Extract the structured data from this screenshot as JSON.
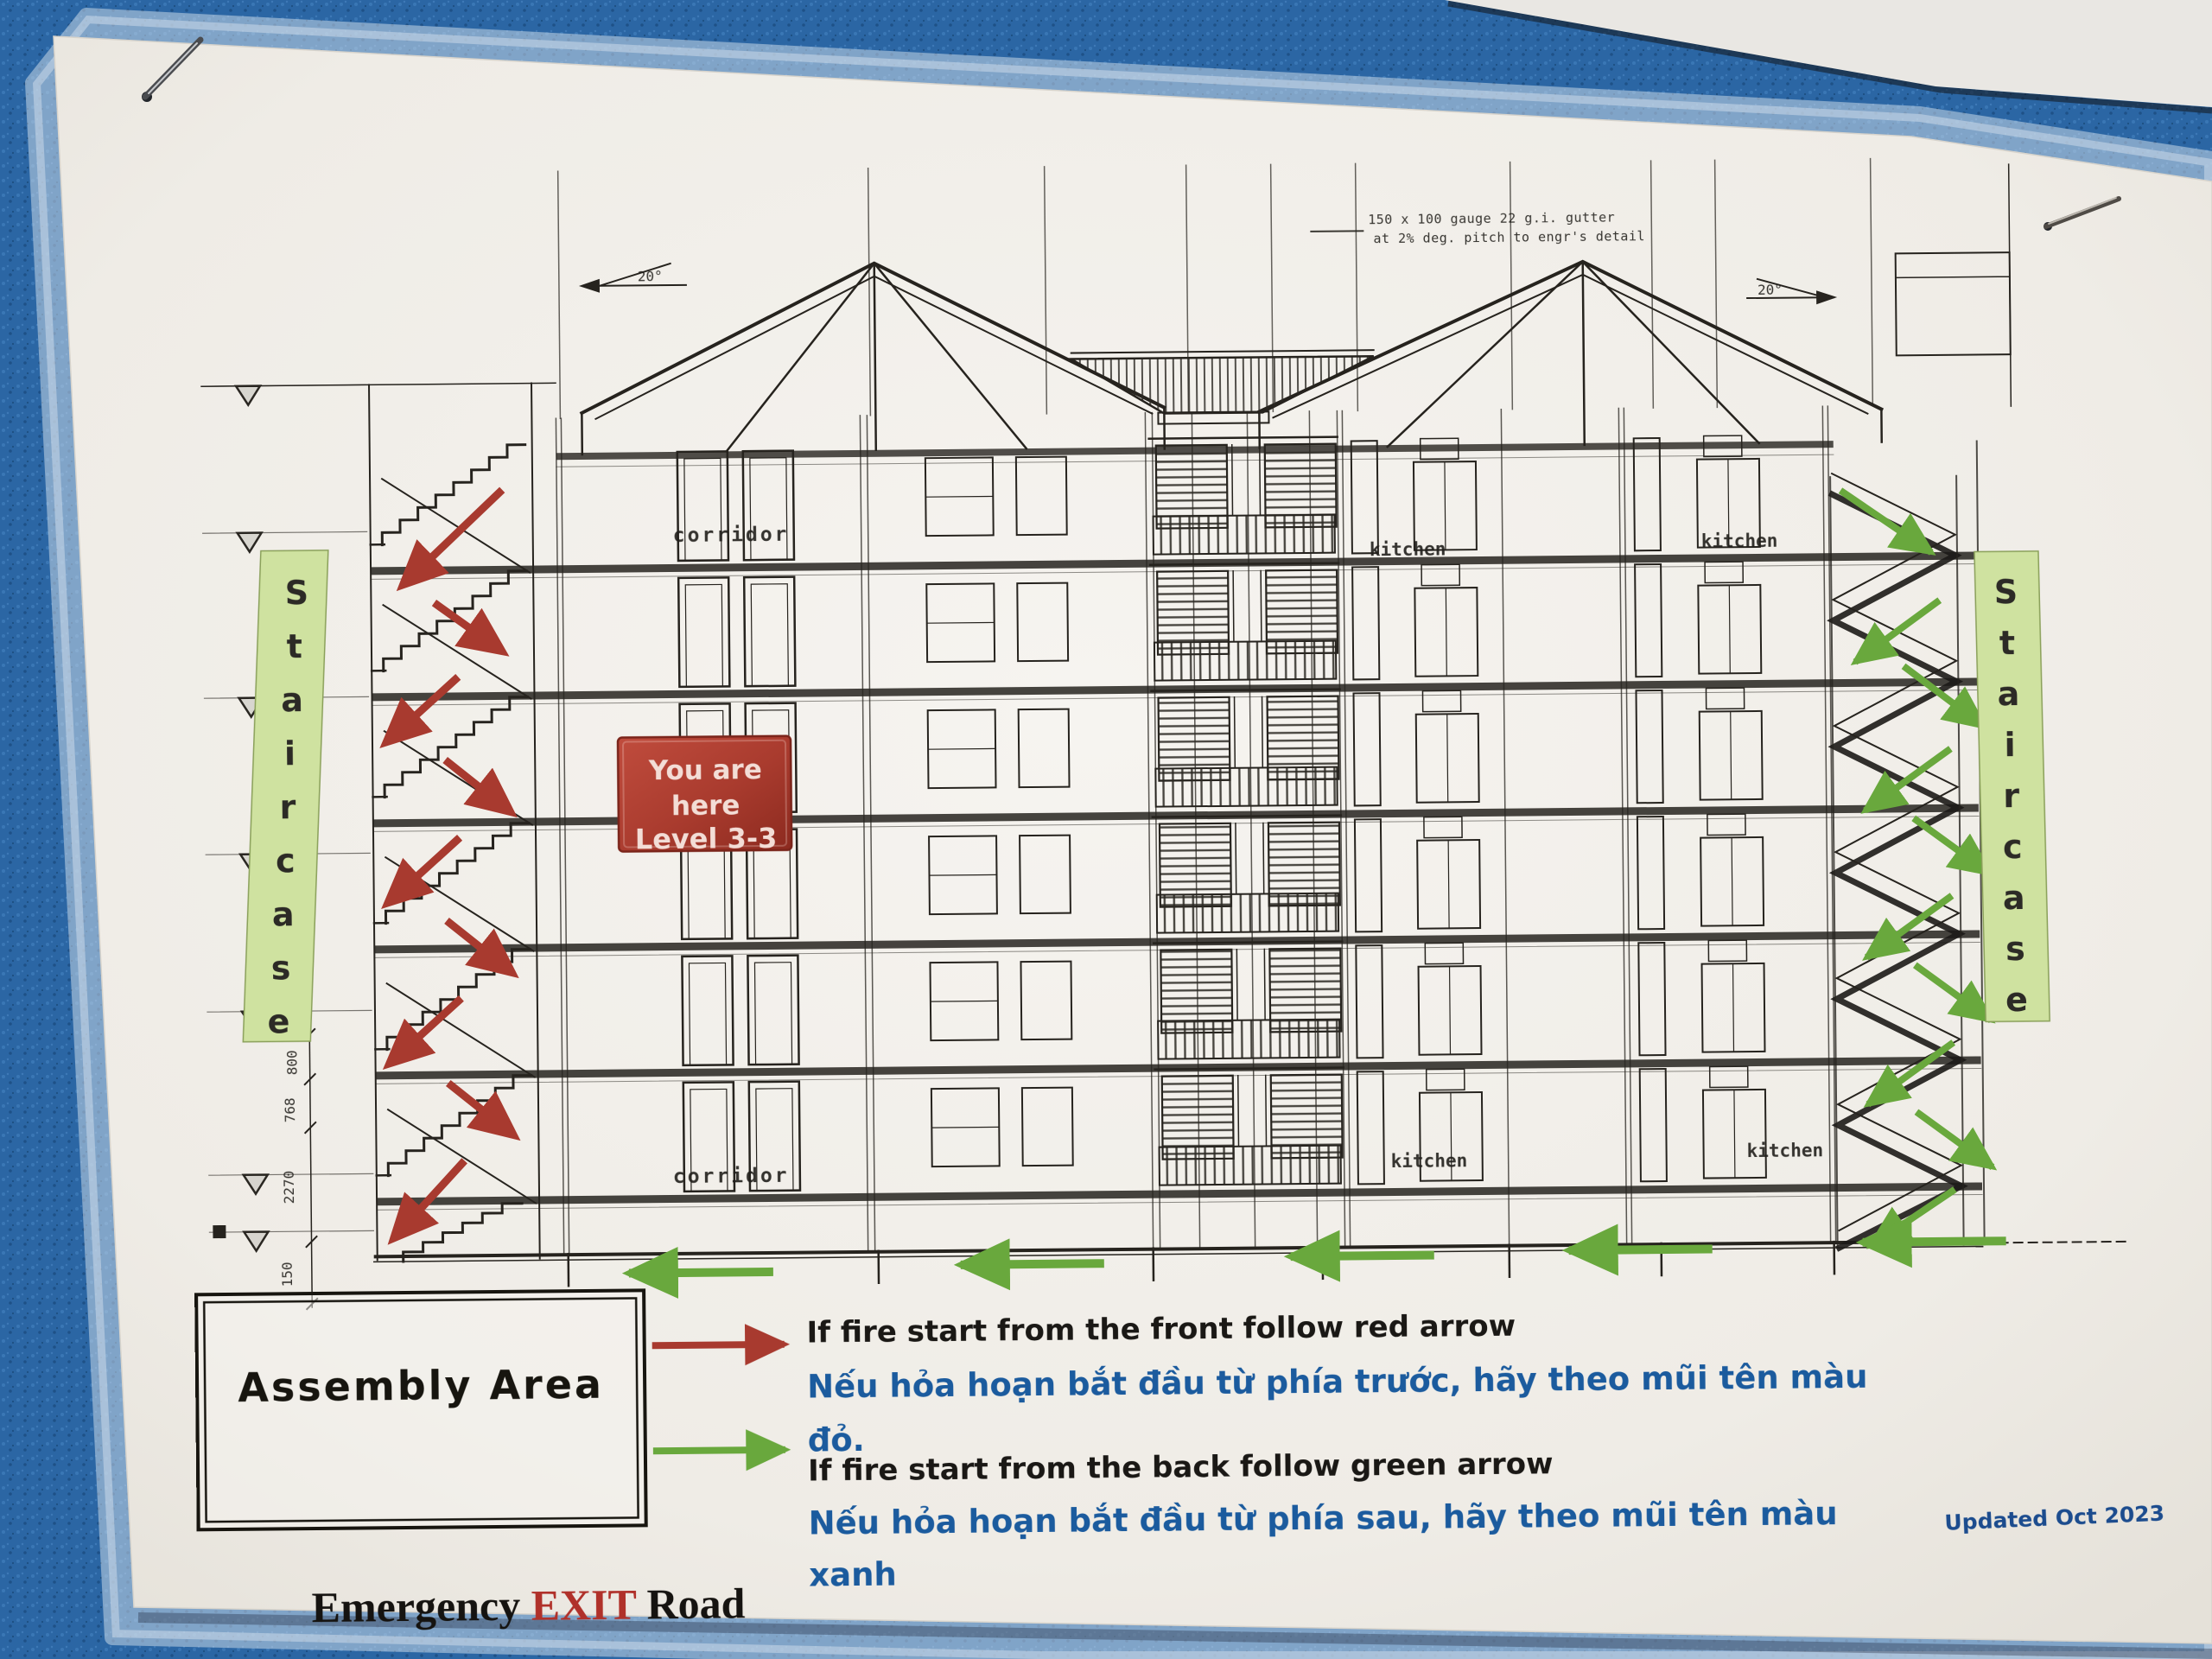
{
  "diagram": {
    "gutter_note": {
      "line1": "150 x 100 gauge 22 g.i. gutter",
      "line2": "at 2% deg. pitch to engr's detail"
    },
    "slope_left_label": "20°",
    "slope_right_label": "20°",
    "corridor_top_label": "corridor",
    "corridor_bottom_label": "corridor",
    "kitchen_labels": {
      "top_left": "kitchen",
      "top_right": "kitchen",
      "bottom_left": "kitchen",
      "bottom_right": "kitchen"
    },
    "dimensions": {
      "d800": "800",
      "d768": "768",
      "d2270": "2270",
      "d150": "150"
    },
    "staircase_left_label": "Staircase",
    "staircase_right_label": "Staircase",
    "staircase_strip_color": "#cfe2a0"
  },
  "you_are_here": {
    "line1": "You are",
    "line2": "here",
    "line3": "Level 3-3",
    "bg_color": "#a93b2e"
  },
  "legend": {
    "red_arrow_color": "#a83a2f",
    "green_arrow_color": "#69a83d",
    "red_en": "If fire start from the front follow red arrow",
    "red_vi_line1": "Nếu hỏa hoạn bắt đầu từ phía trước, hãy theo mũi tên màu",
    "red_vi_line2": "đỏ.",
    "green_en": "If fire start from the back follow green arrow",
    "green_vi_line1": "Nếu hỏa hoạn bắt đầu từ phía sau, hãy theo mũi tên màu",
    "green_vi_line2": "xanh",
    "vi_text_color": "#1b5b9e"
  },
  "assembly_area": {
    "label": "Assembly Area"
  },
  "exit_road": {
    "word1": "Emergency ",
    "word2": "EXIT",
    "word3": " Road",
    "exit_color": "#b0312a"
  },
  "updated_label": "Updated Oct 2023"
}
